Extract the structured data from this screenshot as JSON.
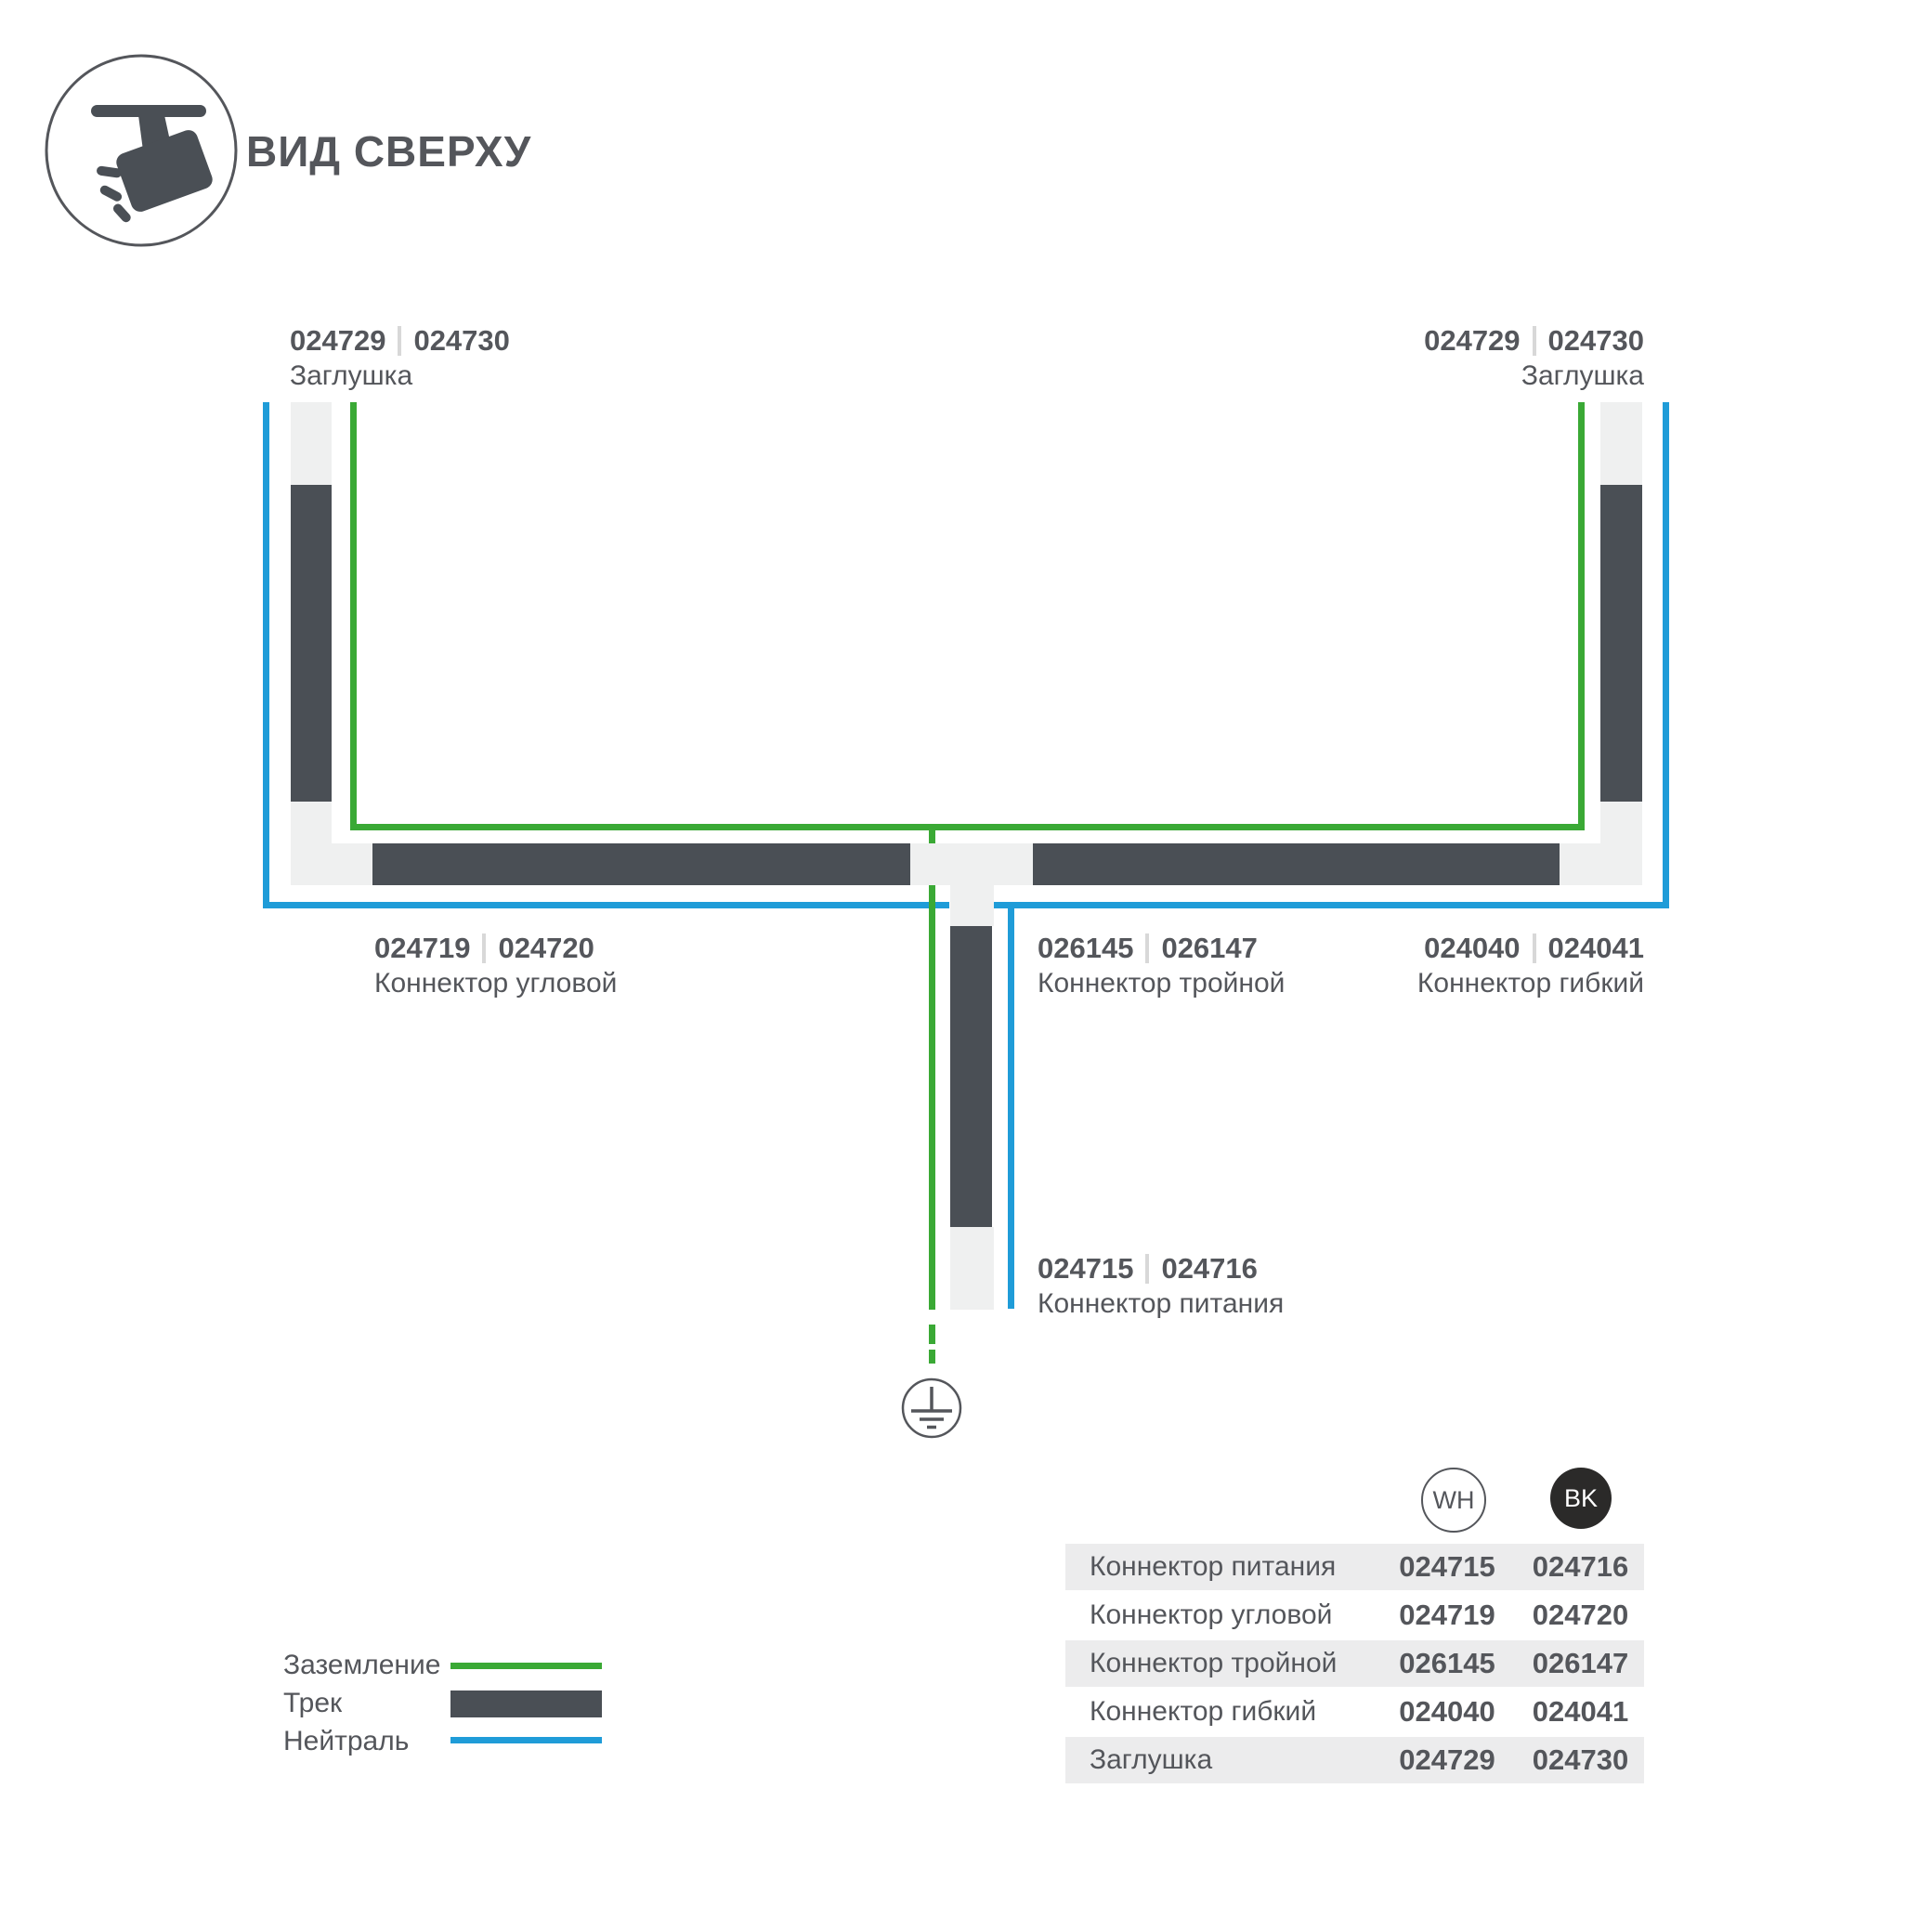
{
  "header": {
    "title": "ВИД СВЕРХУ"
  },
  "colors": {
    "track_dark": "#4a4f55",
    "track_light": "#eff0f0",
    "ground_green": "#3aa935",
    "neutral_blue": "#1f9cd8",
    "text_gray": "#54565b",
    "table_row_gray": "#ececed",
    "bk_badge": "#2b2a29"
  },
  "diagram": {
    "labels": {
      "end_cap_left": {
        "code_wh": "024729",
        "code_bk": "024730",
        "name": "Заглушка"
      },
      "end_cap_right": {
        "code_wh": "024729",
        "code_bk": "024730",
        "name": "Заглушка"
      },
      "corner_connector": {
        "code_wh": "024719",
        "code_bk": "024720",
        "name": "Коннектор угловой"
      },
      "triple_connector": {
        "code_wh": "026145",
        "code_bk": "026147",
        "name": "Коннектор тройной"
      },
      "flexible_connector": {
        "code_wh": "024040",
        "code_bk": "024041",
        "name": "Коннектор гибкий"
      },
      "power_connector": {
        "code_wh": "024715",
        "code_bk": "024716",
        "name": "Коннектор питания"
      }
    }
  },
  "legend": {
    "items": [
      {
        "label": "Заземление",
        "swatch": "green-line"
      },
      {
        "label": "Трек",
        "swatch": "dark-bar"
      },
      {
        "label": "Нейтраль",
        "swatch": "blue-line"
      }
    ]
  },
  "table": {
    "columns": {
      "wh": "WH",
      "bk": "BK"
    },
    "rows": [
      {
        "name": "Коннектор питания",
        "wh": "024715",
        "bk": "024716"
      },
      {
        "name": "Коннектор угловой",
        "wh": "024719",
        "bk": "024720"
      },
      {
        "name": "Коннектор тройной",
        "wh": "026145",
        "bk": "026147"
      },
      {
        "name": "Коннектор гибкий",
        "wh": "024040",
        "bk": "024041"
      },
      {
        "name": "Заглушка",
        "wh": "024729",
        "bk": "024730"
      }
    ]
  }
}
